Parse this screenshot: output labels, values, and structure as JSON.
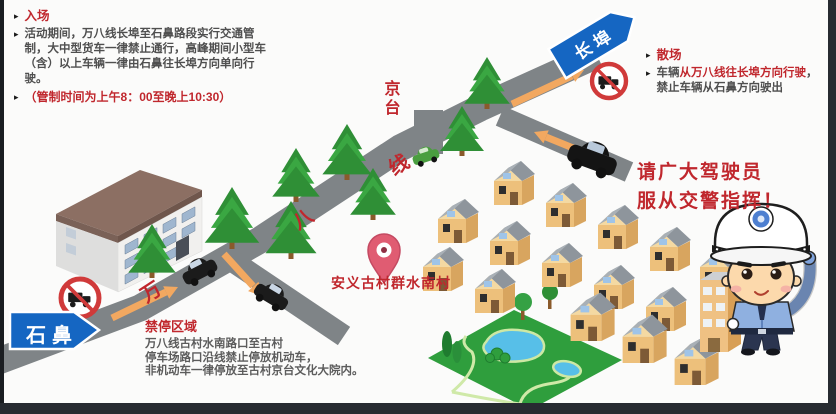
{
  "notices": {
    "entry": {
      "title": "入场",
      "body": "活动期间，万八线长埠至石鼻路段实行交通管制，大中型货车一律禁止通行，高峰期间小型车（含）以上车辆一律由石鼻往长埠方向单向行驶。",
      "time_note": "（管制时间为上午8：00至晚上10:30）"
    },
    "exit": {
      "title": "散场",
      "segments": [
        {
          "text": "车辆",
          "em": false
        },
        {
          "text": "从万八线往长埠方向行驶",
          "em": true
        },
        {
          "text": "，禁止车辆从石鼻方向驶出",
          "em": false
        }
      ]
    },
    "no_parking": {
      "title": "禁停区域",
      "lines": [
        "万八线古村水南路口至古村",
        "停车场路口沿线禁止停放机动车，",
        "非机动车一律停放至古村京台文化大院内。"
      ]
    },
    "obey": {
      "line1": "请广大驾驶员",
      "line2": "服从交警指挥！"
    }
  },
  "map": {
    "destination_signs": {
      "shibi": "石鼻",
      "changbu": "长埠"
    },
    "road_name_chars": {
      "wan": "万",
      "ba": "八",
      "xian": "线"
    },
    "branch_label": "京台",
    "village_label": "安义古村群水南村",
    "icons": [
      "location-pin-icon",
      "no-trucks-sign-icon",
      "pine-tree-icon",
      "car-icon",
      "police-officer-icon",
      "direction-arrow"
    ]
  },
  "ui": {
    "bullet": "▸"
  },
  "colors": {
    "accent_red": "#c0272d",
    "sign_blue": "#1566c2",
    "road_gray": "#7f8487",
    "arrow_orange": "#f2a860",
    "park_green": "#2f9e3d",
    "pond_blue": "#57bfe8"
  }
}
